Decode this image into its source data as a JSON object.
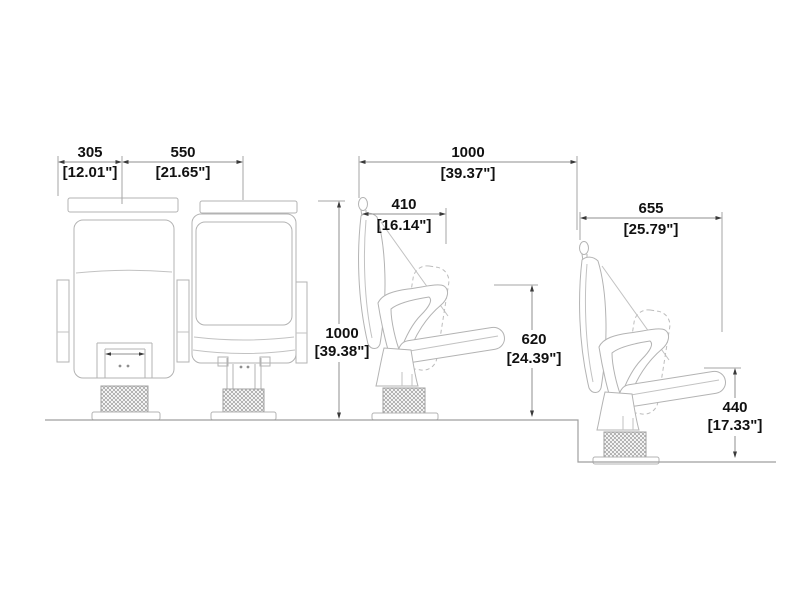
{
  "drawing": {
    "background": "#ffffff",
    "colors": {
      "drawing_line": "#b3b3b3",
      "dimension_line": "#8f8f8f",
      "dimension_text": "#111111",
      "knurl_pattern": "#9a9a9a"
    },
    "dimensions": {
      "left_width": {
        "mm": "305",
        "inch": "[12.01\"]"
      },
      "seat_width": {
        "mm": "550",
        "inch": "[21.65\"]"
      },
      "overall_depth": {
        "mm": "1000",
        "inch": "[39.37\"]"
      },
      "open_seat_depth": {
        "mm": "410",
        "inch": "[16.14\"]"
      },
      "overall_height": {
        "mm": "1000",
        "inch": "[39.38\"]"
      },
      "armrest_height": {
        "mm": "620",
        "inch": "[24.39\"]"
      },
      "folded_depth": {
        "mm": "655",
        "inch": "[25.79\"]"
      },
      "seat_height": {
        "mm": "440",
        "inch": "[17.33\"]"
      }
    }
  }
}
